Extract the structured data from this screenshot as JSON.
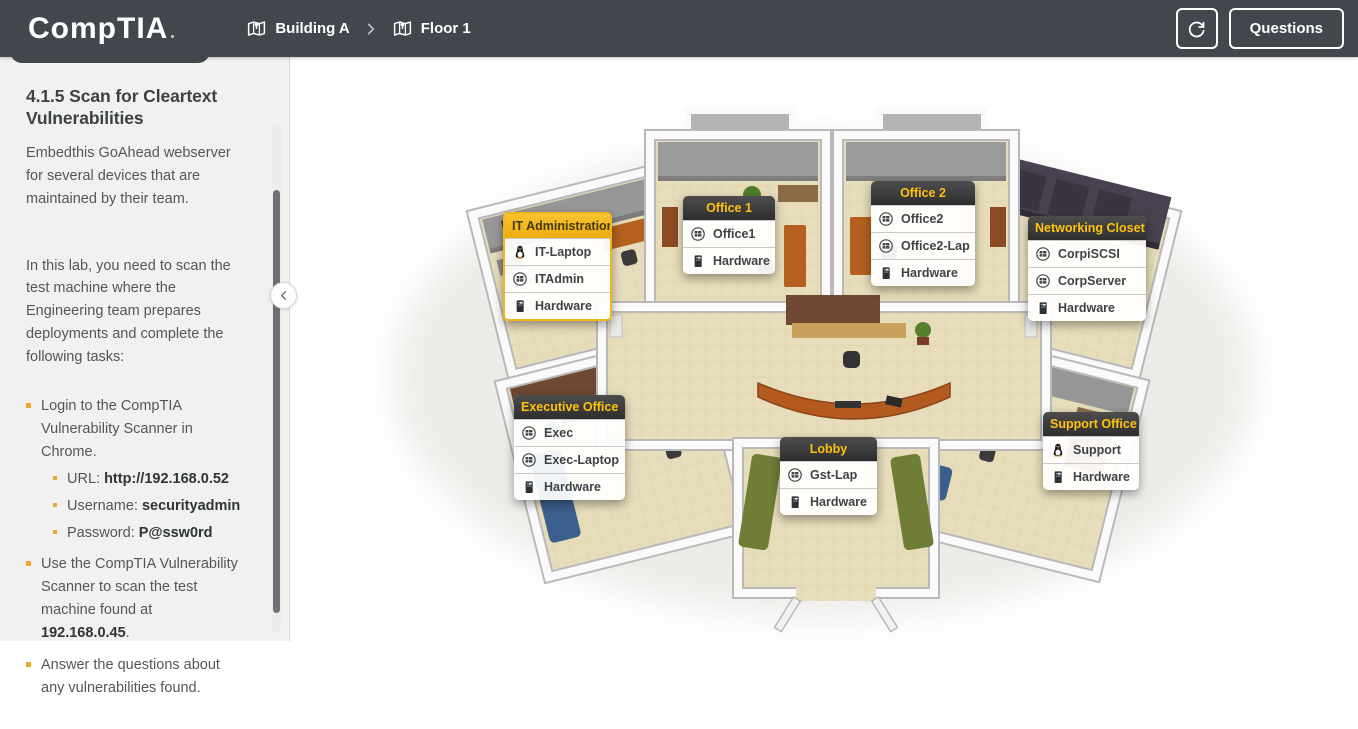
{
  "topbar": {
    "logo": "CompTIA",
    "breadcrumb": [
      {
        "label": "Building A",
        "icon": "map-icon"
      },
      {
        "label": "Floor 1",
        "icon": "map-icon"
      }
    ],
    "refresh_icon": "refresh-icon",
    "questions_label": "Questions"
  },
  "sidebar": {
    "title": "4.1.5 Scan for Cleartext Vulnerabilities",
    "intro": "Embedthis GoAhead webserver for several devices that are maintained by their team.",
    "lab_description": "In this lab, you need to scan the test machine where the Engineering team prepares deployments and complete the following tasks:",
    "tasks": [
      {
        "text": "Login to the CompTIA Vulnerability Scanner in Chrome.",
        "subitems": [
          {
            "label": "URL: ",
            "value": "http://192.168.0.52"
          },
          {
            "label": "Username: ",
            "value": "securityadmin"
          },
          {
            "label": "Password: ",
            "value": "P@ssw0rd"
          }
        ]
      },
      {
        "prefix": "Use the CompTIA Vulnerability Scanner to scan the test machine found at ",
        "value": "192.168.0.45",
        "suffix": "."
      },
      {
        "text": "Answer the questions about any vulnerabilities found."
      }
    ],
    "bullet_color": "#eaa82c"
  },
  "floorplan": {
    "colors": {
      "accent_yellow": "#f2b51d",
      "header_dark": "#3a3a3a",
      "header_text_yellow": "#ffc20e"
    },
    "panels": [
      {
        "title": "IT Administration",
        "highlighted": true,
        "items": [
          {
            "icon": "linux-icon",
            "label": "IT-Laptop"
          },
          {
            "icon": "windows-icon",
            "label": "ITAdmin"
          },
          {
            "icon": "hardware-icon",
            "label": "Hardware"
          }
        ]
      },
      {
        "title": "Office 1",
        "highlighted": false,
        "items": [
          {
            "icon": "windows-icon",
            "label": "Office1"
          },
          {
            "icon": "hardware-icon",
            "label": "Hardware"
          }
        ]
      },
      {
        "title": "Office 2",
        "highlighted": false,
        "items": [
          {
            "icon": "windows-icon",
            "label": "Office2"
          },
          {
            "icon": "windows-icon",
            "label": "Office2-Lap"
          },
          {
            "icon": "hardware-icon",
            "label": "Hardware"
          }
        ]
      },
      {
        "title": "Networking Closet",
        "highlighted": false,
        "items": [
          {
            "icon": "windows-icon",
            "label": "CorpiSCSI"
          },
          {
            "icon": "windows-icon",
            "label": "CorpServer"
          },
          {
            "icon": "hardware-icon",
            "label": "Hardware"
          }
        ]
      },
      {
        "title": "Executive Office",
        "highlighted": false,
        "items": [
          {
            "icon": "windows-icon",
            "label": "Exec"
          },
          {
            "icon": "windows-icon",
            "label": "Exec-Laptop"
          },
          {
            "icon": "hardware-icon",
            "label": "Hardware"
          }
        ]
      },
      {
        "title": "Lobby",
        "highlighted": false,
        "items": [
          {
            "icon": "windows-icon",
            "label": "Gst-Lap"
          },
          {
            "icon": "hardware-icon",
            "label": "Hardware"
          }
        ]
      },
      {
        "title": "Support Office",
        "highlighted": false,
        "items": [
          {
            "icon": "linux-icon",
            "label": "Support"
          },
          {
            "icon": "hardware-icon",
            "label": "Hardware"
          }
        ]
      }
    ]
  }
}
